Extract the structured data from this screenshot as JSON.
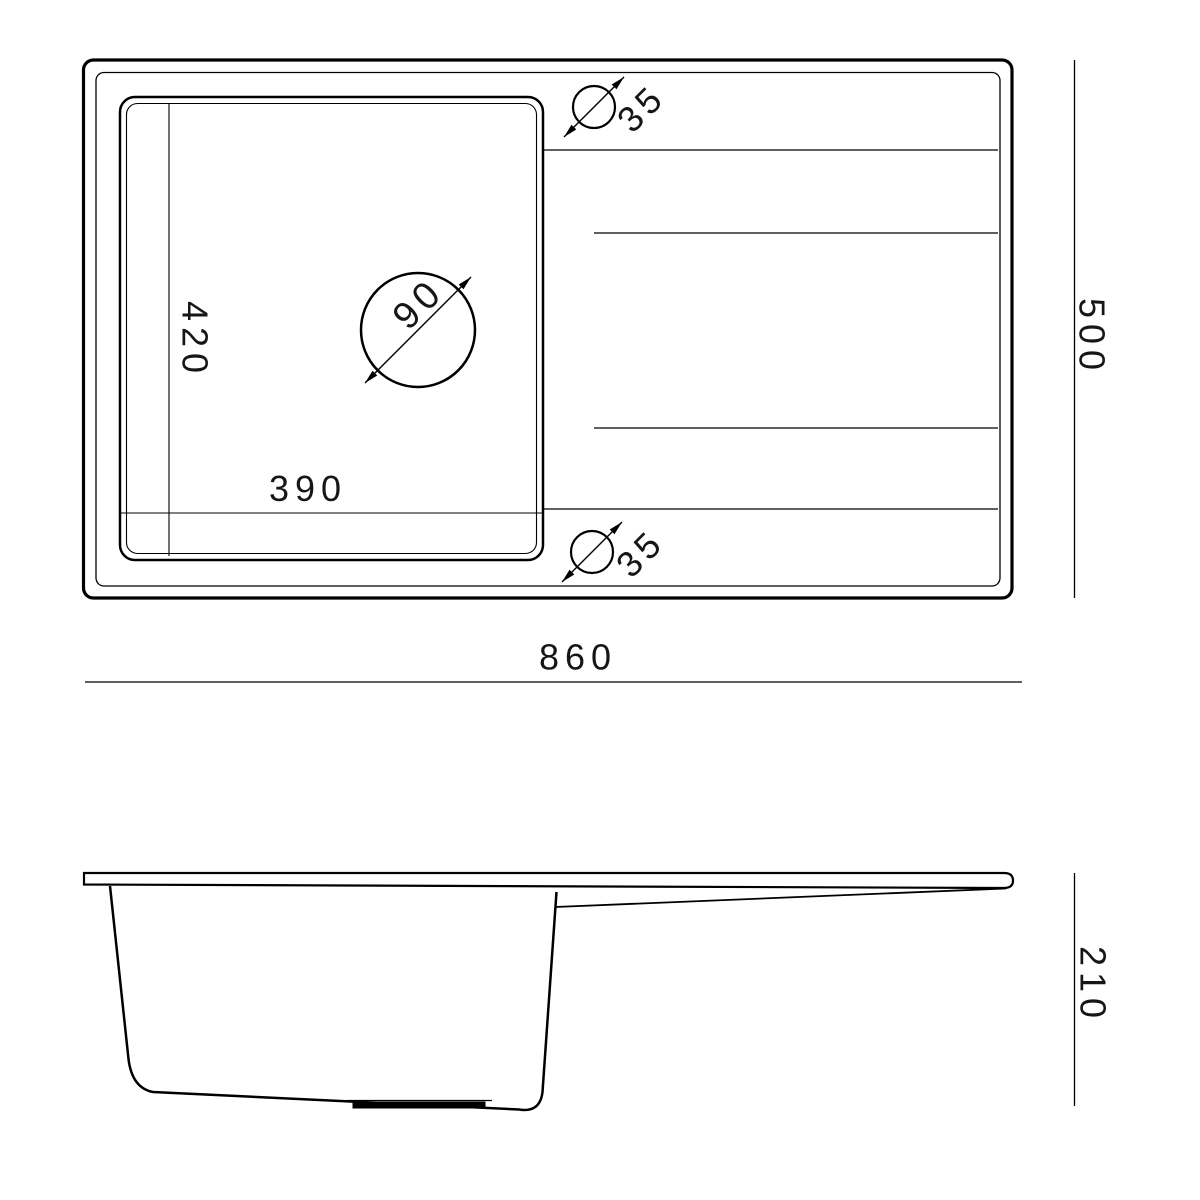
{
  "drawing": {
    "top_view": {
      "overall_width_label": "860",
      "overall_depth_label": "500",
      "bowl_width_label": "390",
      "bowl_depth_label": "420",
      "drain_hole_diameter_label": "90",
      "tap_hole_top_diameter_label": "35",
      "tap_hole_bottom_diameter_label": "35"
    },
    "side_view": {
      "height_label": "210"
    },
    "colors": {
      "line": "#000000",
      "text": "#161616",
      "background": "#ffffff"
    }
  }
}
